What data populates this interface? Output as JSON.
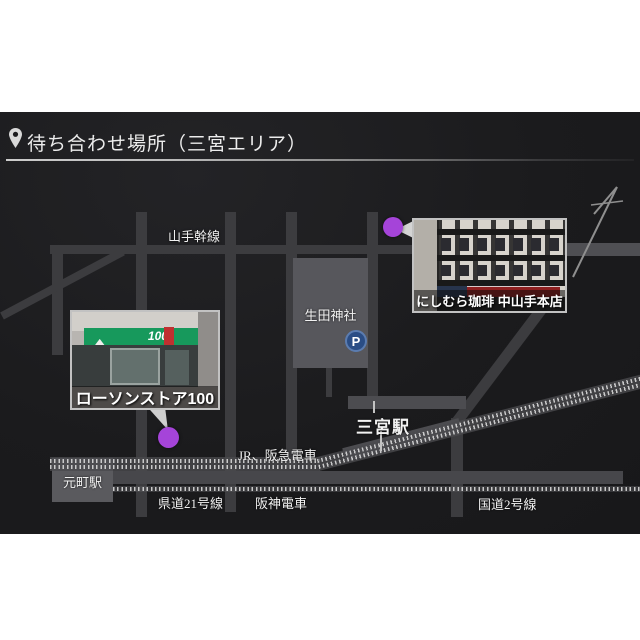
{
  "header": {
    "title": "待ち合わせ場所（三宮エリア）"
  },
  "map": {
    "labels": [
      {
        "id": "yamate-kansen",
        "text": "山手幹線"
      },
      {
        "id": "ikuta-shrine",
        "text": "生田神社"
      },
      {
        "id": "sannomiya-sta",
        "text": "三宮駅"
      },
      {
        "id": "jr-hankyu",
        "text": "JR、阪急電車"
      },
      {
        "id": "motomachi-sta",
        "text": "元町駅"
      },
      {
        "id": "kendo-21",
        "text": "県道21号線"
      },
      {
        "id": "hanshin",
        "text": "阪神電車"
      },
      {
        "id": "kokudo-2",
        "text": "国道2号線"
      }
    ],
    "markers": {
      "parking_label": "P"
    },
    "locations": [
      {
        "name": "ローソンストア100",
        "sign": "100"
      },
      {
        "name": "にしむら珈琲 中山手本店"
      }
    ],
    "colors": {
      "card_bg": "#1b1b1d",
      "road": "#3c3c3f",
      "road_light": "#4f4f53",
      "block": "#57575c",
      "station": "#4c4c50",
      "marker_purple": "#a544d9",
      "parking_blue": "#2a4d85",
      "photo_border": "#c2c2c2"
    }
  }
}
